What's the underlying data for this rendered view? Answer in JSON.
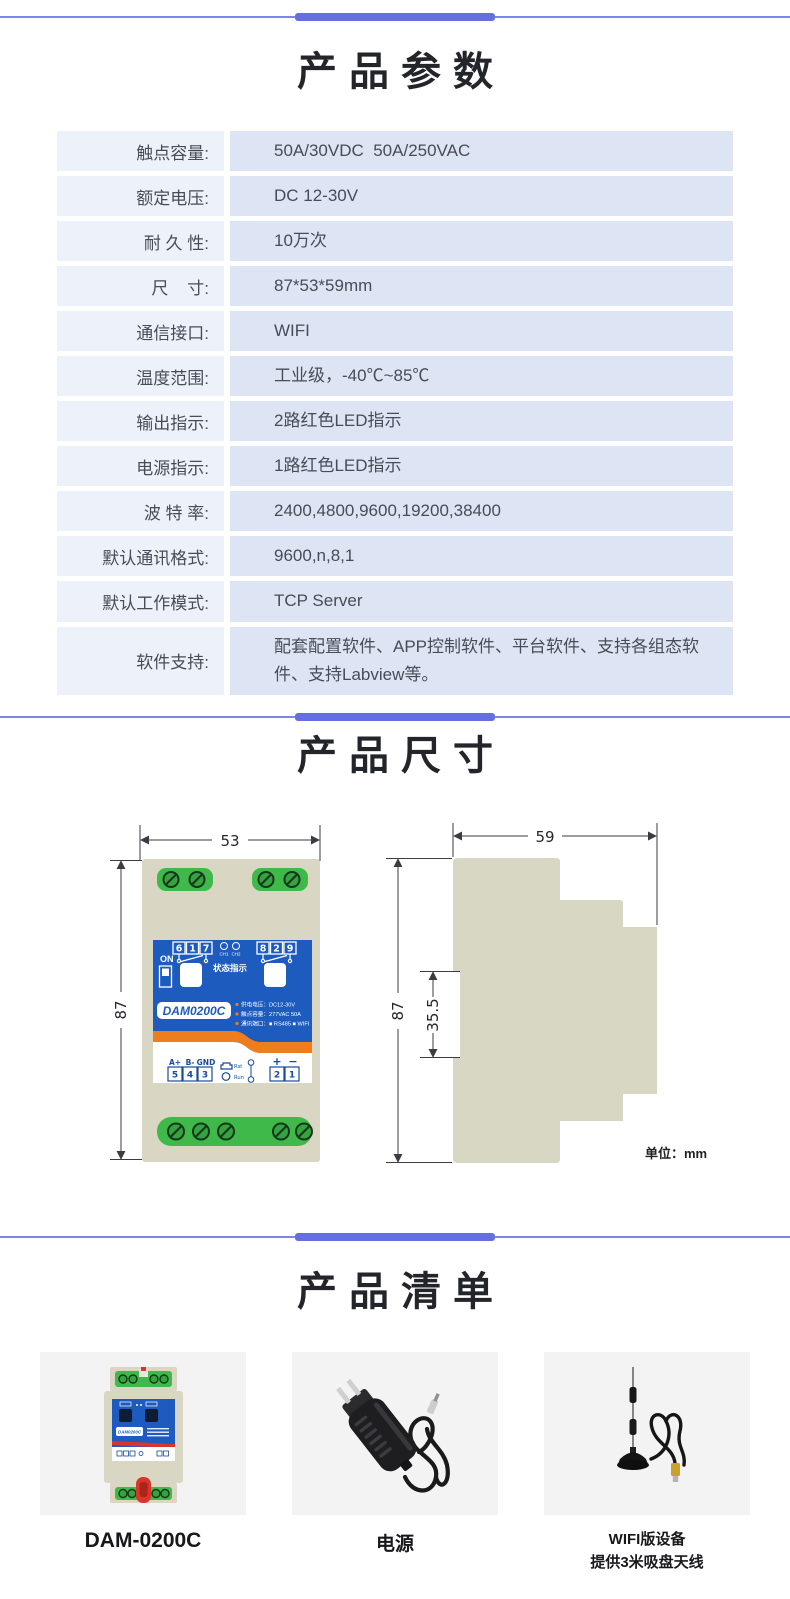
{
  "sections": {
    "params_title": "产品参数",
    "dims_title": "产品尺寸",
    "list_title": "产品清单"
  },
  "colors": {
    "divider": "#6470dd",
    "divider_thin": "#7d86e8",
    "table_label_bg": "#edf1f9",
    "table_value_bg": "#dde4f3",
    "device_blue": "#1d5bbf",
    "device_green": "#3eb94a",
    "device_beige": "#d9d6c3",
    "device_orange": "#ee7d1e",
    "connector_red": "#d9352b",
    "card_bg": "#f3f3f4"
  },
  "spec_table": {
    "rows": [
      {
        "label": "触点容量:",
        "value": "50A/30VDC  50A/250VAC"
      },
      {
        "label": "额定电压:",
        "value": "DC 12-30V"
      },
      {
        "label": "耐 久 性:",
        "value": "10万次"
      },
      {
        "label": "尺    寸:",
        "value": "87*53*59mm"
      },
      {
        "label": "通信接口:",
        "value": "WIFI"
      },
      {
        "label": "温度范围:",
        "value": "工业级，-40℃~85℃"
      },
      {
        "label": "输出指示:",
        "value": "2路红色LED指示"
      },
      {
        "label": "电源指示:",
        "value": "1路红色LED指示"
      },
      {
        "label": "波 特 率:",
        "value": "2400,4800,9600,19200,38400"
      },
      {
        "label": "默认通讯格式:",
        "value": "9600,n,8,1"
      },
      {
        "label": "默认工作模式:",
        "value": "TCP Server"
      },
      {
        "label": "软件支持:",
        "value": "配套配置软件、APP控制软件、平台软件、支持各组态软件、支持Labview等。"
      }
    ]
  },
  "dimensions": {
    "unit_note": "单位：mm",
    "front": {
      "width": "53",
      "height": "87"
    },
    "side": {
      "width": "59",
      "height": "87",
      "groove": "35.5"
    },
    "device": {
      "on_label": "ON",
      "relay1_terminals": [
        "6",
        "1",
        "7"
      ],
      "relay2_terminals": [
        "8",
        "2",
        "9"
      ],
      "ch1": "CH1",
      "ch2": "CH2",
      "status_label": "状态指示",
      "model": "DAM0200C",
      "spec_lines": [
        "供电电压：DC12-30V",
        "触点容量：277VAC 50A",
        "通讯端口：■ RS485  ■ WIFI"
      ],
      "io_labels": [
        "A+",
        "B-",
        "GND"
      ],
      "io_terminals": [
        "5",
        "4",
        "3"
      ],
      "rst_label": "Rst",
      "run_label": "Run",
      "power_labels": [
        "+",
        "−"
      ],
      "power_terminals": [
        "2",
        "1"
      ]
    }
  },
  "products": [
    {
      "caption_lines": [
        "DAM-0200C"
      ]
    },
    {
      "caption_lines": [
        "电源"
      ]
    },
    {
      "caption_lines": [
        "WIFI版设备",
        "提供3米吸盘天线"
      ]
    }
  ]
}
